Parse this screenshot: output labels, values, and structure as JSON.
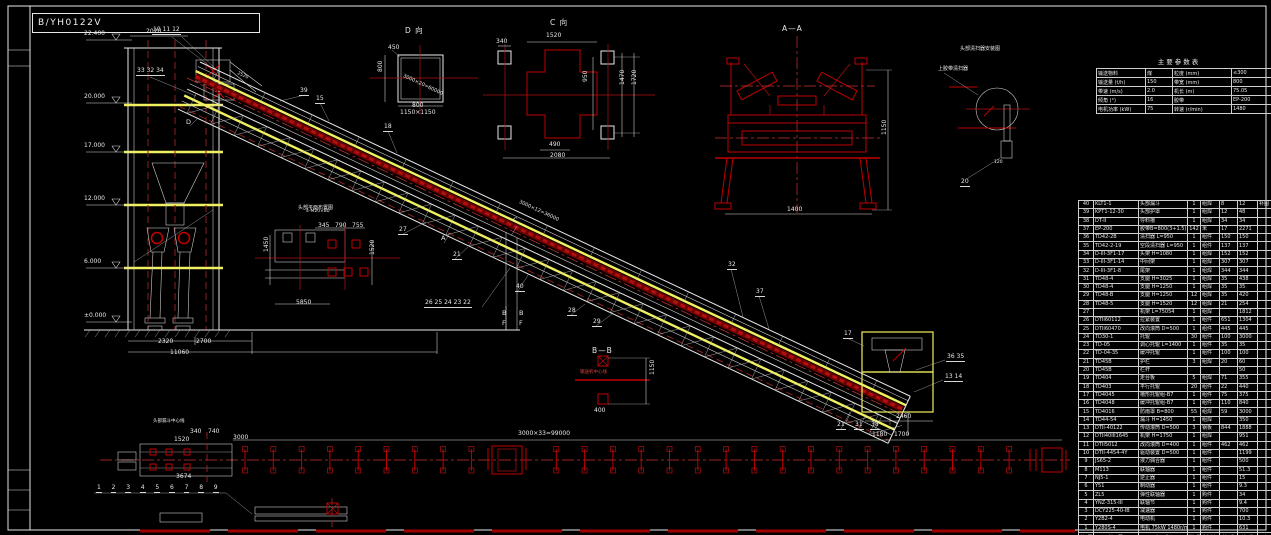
{
  "title": {
    "drawing_no": "B/YH0122V"
  },
  "elevations": [
    {
      "label": "22.400",
      "y": 40
    },
    {
      "label": "20.000",
      "y": 103
    },
    {
      "label": "17.000",
      "y": 152
    },
    {
      "label": "12.000",
      "y": 205
    },
    {
      "label": "6.000",
      "y": 268
    },
    {
      "label": "±0.000",
      "y": 322
    }
  ],
  "annotations": [
    {
      "t": "D 向",
      "x": 405,
      "y": 27,
      "k": "v"
    },
    {
      "t": "C 向",
      "x": 550,
      "y": 19,
      "k": "v"
    },
    {
      "t": "A—A",
      "x": 782,
      "y": 25,
      "k": "v"
    },
    {
      "t": "B—B",
      "x": 592,
      "y": 347,
      "k": "v"
    },
    {
      "t": "头部清扫器安装图",
      "x": 960,
      "y": 47,
      "s": 5
    },
    {
      "t": "上胶带清扫器",
      "x": 938,
      "y": 67,
      "s": 5
    },
    {
      "t": "头部平面布置图",
      "x": 298,
      "y": 206,
      "s": 5
    },
    {
      "t": "头部漏斗中心线",
      "x": 153,
      "y": 420,
      "s": 4.5
    },
    {
      "t": "输送机中心线",
      "x": 580,
      "y": 371,
      "s": 4.5,
      "k": "red"
    },
    {
      "t": "D",
      "x": 186,
      "y": 119,
      "k": "l"
    },
    {
      "t": "C",
      "x": 513,
      "y": 217,
      "k": "l"
    },
    {
      "t": "A",
      "x": 441,
      "y": 235,
      "k": "l"
    },
    {
      "t": "B",
      "x": 502,
      "y": 310,
      "k": "l"
    },
    {
      "t": "F",
      "x": 502,
      "y": 320,
      "k": "l"
    },
    {
      "t": "B",
      "x": 519,
      "y": 310,
      "k": "l"
    },
    {
      "t": "F",
      "x": 519,
      "y": 320,
      "k": "l"
    },
    {
      "t": "10 11 12",
      "x": 152,
      "y": 27,
      "k": "c"
    },
    {
      "t": "33 32 34",
      "x": 136,
      "y": 68,
      "k": "c"
    },
    {
      "t": "39",
      "x": 299,
      "y": 88,
      "k": "c"
    },
    {
      "t": "15",
      "x": 315,
      "y": 96,
      "k": "c"
    },
    {
      "t": "18",
      "x": 383,
      "y": 124,
      "k": "c"
    },
    {
      "t": "27",
      "x": 398,
      "y": 227,
      "k": "c"
    },
    {
      "t": "21",
      "x": 452,
      "y": 252,
      "k": "c"
    },
    {
      "t": "40",
      "x": 515,
      "y": 284,
      "k": "c"
    },
    {
      "t": "26 25 24 23 22",
      "x": 424,
      "y": 300,
      "k": "c"
    },
    {
      "t": "28",
      "x": 567,
      "y": 308,
      "k": "c"
    },
    {
      "t": "29",
      "x": 592,
      "y": 319,
      "k": "c"
    },
    {
      "t": "32",
      "x": 727,
      "y": 262,
      "k": "c"
    },
    {
      "t": "37",
      "x": 755,
      "y": 289,
      "k": "c"
    },
    {
      "t": "17",
      "x": 843,
      "y": 331,
      "k": "c"
    },
    {
      "t": "36 35",
      "x": 946,
      "y": 354,
      "k": "c"
    },
    {
      "t": "13 14",
      "x": 944,
      "y": 374,
      "k": "c"
    },
    {
      "t": "21",
      "x": 836,
      "y": 422,
      "k": "c"
    },
    {
      "t": "31",
      "x": 854,
      "y": 422,
      "k": "c"
    },
    {
      "t": "38",
      "x": 870,
      "y": 422,
      "k": "c"
    },
    {
      "t": "20",
      "x": 960,
      "y": 179,
      "k": "c"
    },
    {
      "t": "2020",
      "x": 146,
      "y": 29
    },
    {
      "t": "2520",
      "x": 238,
      "y": 72,
      "r": 25,
      "s": 4.5
    },
    {
      "t": "2320",
      "x": 158,
      "y": 339
    },
    {
      "t": "2700",
      "x": 196,
      "y": 339
    },
    {
      "t": "11060",
      "x": 170,
      "y": 350
    },
    {
      "t": "3000×20=60000",
      "x": 404,
      "y": 74,
      "r": 25,
      "s": 5
    },
    {
      "t": "3000×12=36000",
      "x": 520,
      "y": 200,
      "r": 25,
      "s": 5
    },
    {
      "t": "4-M20×80",
      "x": 306,
      "y": 210,
      "s": 4.5
    },
    {
      "t": "450",
      "x": 388,
      "y": 45
    },
    {
      "t": "800",
      "x": 412,
      "y": 103
    },
    {
      "t": "1150×1150",
      "x": 400,
      "y": 110
    },
    {
      "t": "800",
      "x": 378,
      "y": 72,
      "r": -90
    },
    {
      "t": "340",
      "x": 496,
      "y": 39
    },
    {
      "t": "1520",
      "x": 546,
      "y": 33
    },
    {
      "t": "490",
      "x": 549,
      "y": 142
    },
    {
      "t": "2080",
      "x": 550,
      "y": 153
    },
    {
      "t": "950",
      "x": 583,
      "y": 82,
      "r": -90
    },
    {
      "t": "1470",
      "x": 620,
      "y": 85,
      "r": -90
    },
    {
      "t": "1720",
      "x": 632,
      "y": 85,
      "r": -90
    },
    {
      "t": "1400",
      "x": 787,
      "y": 207
    },
    {
      "t": "1150",
      "x": 882,
      "y": 135,
      "r": -90
    },
    {
      "t": "1150",
      "x": 650,
      "y": 375,
      "r": -90
    },
    {
      "t": "400",
      "x": 594,
      "y": 408
    },
    {
      "t": "345",
      "x": 318,
      "y": 223
    },
    {
      "t": "790",
      "x": 335,
      "y": 223
    },
    {
      "t": "755",
      "x": 352,
      "y": 223
    },
    {
      "t": "1450",
      "x": 264,
      "y": 252,
      "r": -90
    },
    {
      "t": "5850",
      "x": 296,
      "y": 300
    },
    {
      "t": "1520",
      "x": 370,
      "y": 255,
      "r": -90
    },
    {
      "t": "3674",
      "x": 176,
      "y": 474
    },
    {
      "t": "340",
      "x": 190,
      "y": 429
    },
    {
      "t": "740",
      "x": 208,
      "y": 429
    },
    {
      "t": "3000",
      "x": 233,
      "y": 435
    },
    {
      "t": "1520",
      "x": 174,
      "y": 437
    },
    {
      "t": "3000×33=99000",
      "x": 518,
      "y": 431
    },
    {
      "t": "2460",
      "x": 896,
      "y": 414
    },
    {
      "t": "1180",
      "x": 872,
      "y": 432
    },
    {
      "t": "1700",
      "x": 894,
      "y": 432
    },
    {
      "t": "120",
      "x": 994,
      "y": 161,
      "s": 4.5
    }
  ],
  "plan": {
    "numbers": [
      "1",
      "2",
      "3",
      "4",
      "5",
      "6",
      "7",
      "8",
      "9"
    ]
  },
  "param_table": {
    "title": "主要参数表",
    "rows": [
      [
        "输送物料",
        "煤",
        "粒度 (mm)",
        "≤300"
      ],
      [
        "输送量 (t/h)",
        "150",
        "带宽 (mm)",
        "800"
      ],
      [
        "带速 (m/s)",
        "2.0",
        "机长 (m)",
        "75.05"
      ],
      [
        "倾角 (°)",
        "16",
        "胶带",
        "EP-200"
      ],
      [
        "电机功率 (kW)",
        "75",
        "转速 (r/min)",
        "1480"
      ]
    ]
  },
  "bom": {
    "header": [
      "件号",
      "代 号",
      "名 称",
      "数量",
      "材料",
      "单重",
      "总重",
      "备 注"
    ],
    "rows": [
      [
        "40",
        "KLT1-1",
        "头部漏斗",
        "1",
        "组焊",
        "8",
        "12",
        "补图"
      ],
      [
        "39",
        "KPT1-12-30",
        "头部护罩",
        "1",
        "组焊",
        "12",
        "48",
        ""
      ],
      [
        "38",
        "DT-II",
        "导料槽",
        "1",
        "组焊",
        "34",
        "34",
        ""
      ],
      [
        "37",
        "EP-200",
        "胶带B=800(3+1.5)",
        "142",
        "米",
        "17",
        "2271",
        ""
      ],
      [
        "36",
        "TD42-2B",
        "清扫器 L=950",
        "1",
        "组件",
        "150",
        "150",
        ""
      ],
      [
        "35",
        "TD42-2-19",
        "空段清扫器 L=950",
        "1",
        "组件",
        "137",
        "137",
        ""
      ],
      [
        "34",
        "D-III-3F1-17",
        "头架 H=1080",
        "1",
        "组焊",
        "152",
        "152",
        ""
      ],
      [
        "33",
        "D-III-3F1-14",
        "中间架",
        "1",
        "组焊",
        "307",
        "307",
        ""
      ],
      [
        "32",
        "D-III-3F1-8",
        "尾架",
        "1",
        "组焊",
        "344",
        "344",
        ""
      ],
      [
        "31",
        "TD48-4",
        "支腿 H=3025",
        "1",
        "组焊",
        "35",
        "438",
        ""
      ],
      [
        "30",
        "TD48-4",
        "支腿 H=1250",
        "1",
        "组焊",
        "35",
        "35",
        ""
      ],
      [
        "29",
        "TD48-B",
        "支腿 H=1250",
        "12",
        "组焊",
        "35",
        "420",
        ""
      ],
      [
        "28",
        "TD48-5",
        "支腿 H=1520",
        "12",
        "组焊",
        "21",
        "254",
        ""
      ],
      [
        "27",
        "",
        "机架 L=75054",
        "1",
        "组焊",
        "",
        "1812",
        ""
      ],
      [
        "26",
        "DTII60112",
        "拉紧装置",
        "1",
        "组件",
        "651",
        "1304",
        ""
      ],
      [
        "25",
        "DTII60470",
        "改向滚筒 D=500",
        "1",
        "组件",
        "445",
        "445",
        ""
      ],
      [
        "24",
        "TD30-1",
        "托辊",
        "30",
        "组件",
        "100",
        "3000",
        ""
      ],
      [
        "23",
        "TD-05",
        "调心托辊 L=1400",
        "1",
        "组件",
        "35",
        "35",
        ""
      ],
      [
        "22",
        "TD-04-35",
        "缓冲托辊",
        "1",
        "组件",
        "100",
        "100",
        ""
      ],
      [
        "21",
        "TD45B",
        "护栏",
        "3",
        "组焊",
        "20",
        "60",
        ""
      ],
      [
        "20",
        "TD45B",
        "栏杆",
        "",
        "",
        "",
        "50",
        ""
      ],
      [
        "19",
        "TD404",
        "走台板",
        "5",
        "组焊",
        "71",
        "355",
        ""
      ],
      [
        "18",
        "TD403",
        "平行托辊",
        "20",
        "组件",
        "22",
        "440",
        ""
      ],
      [
        "17",
        "TD4045",
        "槽形托辊组-B7",
        "1",
        "组件",
        "75",
        "375",
        ""
      ],
      [
        "16",
        "TD4048",
        "缓冲托辊组-B7",
        "1",
        "组件",
        "110",
        "840",
        ""
      ],
      [
        "15",
        "TD4016",
        "防雨罩 B=800",
        "55",
        "组焊",
        "59",
        "3000",
        ""
      ],
      [
        "14",
        "TD44-54",
        "漏斗 H=1450",
        "1",
        "组焊",
        "",
        "350",
        ""
      ],
      [
        "13",
        "DTII-40122",
        "传动滚筒 D=500",
        "3",
        "钢板",
        "844",
        "1888",
        ""
      ],
      [
        "12",
        "DTII40III1645",
        "机架 H=1750",
        "1",
        "组焊",
        "",
        "951",
        ""
      ],
      [
        "11",
        "DTII5012",
        "改向滚筒 D=400",
        "1",
        "组件",
        "462",
        "462",
        ""
      ],
      [
        "10",
        "DTII-4454-4Y",
        "驱动装置 D=500",
        "1",
        "组件",
        "",
        "1199",
        ""
      ],
      [
        "9",
        "JS65-2",
        "液力偶合器",
        "1",
        "组件",
        "",
        "500",
        ""
      ],
      [
        "8",
        "M113",
        "联轴器",
        "1",
        "组件",
        "",
        "51.3",
        ""
      ],
      [
        "7",
        "NJ5-1",
        "逆止器",
        "1",
        "组件",
        "",
        "15",
        ""
      ],
      [
        "6",
        "Y51",
        "制动器",
        "1",
        "组件",
        "",
        "9.3",
        ""
      ],
      [
        "5",
        "ZL5",
        "弹性联轴器",
        "1",
        "购件",
        "",
        "34",
        ""
      ],
      [
        "4",
        "YNZ-315-III",
        "联轴节",
        "1",
        "购件",
        "",
        "9.4",
        ""
      ],
      [
        "3",
        "DCY225-40-IB",
        "减速器",
        "1",
        "购件",
        "",
        "700",
        ""
      ],
      [
        "2",
        "Y2B2-4",
        "电动机",
        "1",
        "购件",
        "",
        "10.3",
        ""
      ],
      [
        "1",
        "Y280S-4",
        "电机 75kW 1480r/min",
        "1",
        "购件",
        "",
        "631",
        ""
      ]
    ]
  }
}
